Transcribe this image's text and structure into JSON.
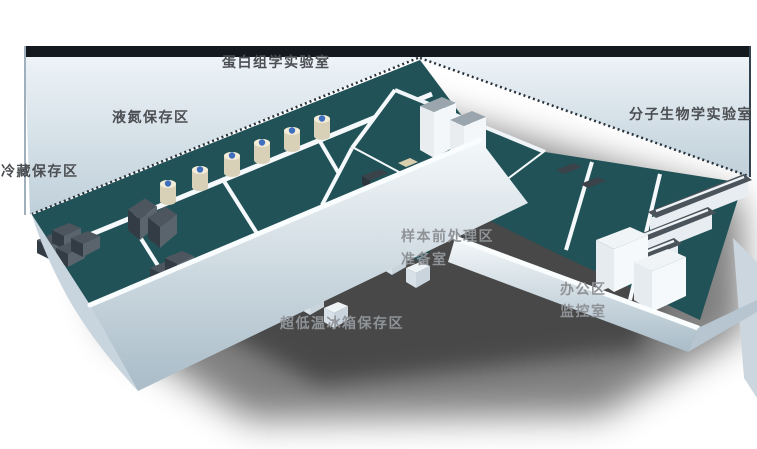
{
  "scene": {
    "type": "3d-isometric-floorplan",
    "description": "Cutaway 3D rendering of an L-shaped biobank laboratory with labelled functional zones"
  },
  "labels": {
    "proteomics_lab": "蛋白组学实验室",
    "liquid_nitrogen_storage": "液氮保存区",
    "cold_storage": "冷藏保存区",
    "molecular_biology_lab": "分子生物学实验室",
    "sample_pretreatment": "样本前处理区",
    "preparation_room": "准备室",
    "office_area": "办公区",
    "monitoring_room": "监控室",
    "ultra_low_freezer_storage": "超低温冰箱保存区"
  },
  "colors": {
    "background": "#ffffff",
    "label_dark": "#4b4e52",
    "label_light": "#8f9397",
    "floor_teal": "#215257",
    "wall_panel_light": "#e9f0f5",
    "wall_panel_shade": "#c0cfd9",
    "wall_top_rim": "#13191f",
    "wall_white": "#f7fafc",
    "freezer_dark": "#4d565e",
    "tank_body": "#eae0c6",
    "tank_cap": "#3f6fbe",
    "bench_top": "#4b535b",
    "shadow": "#000000"
  }
}
